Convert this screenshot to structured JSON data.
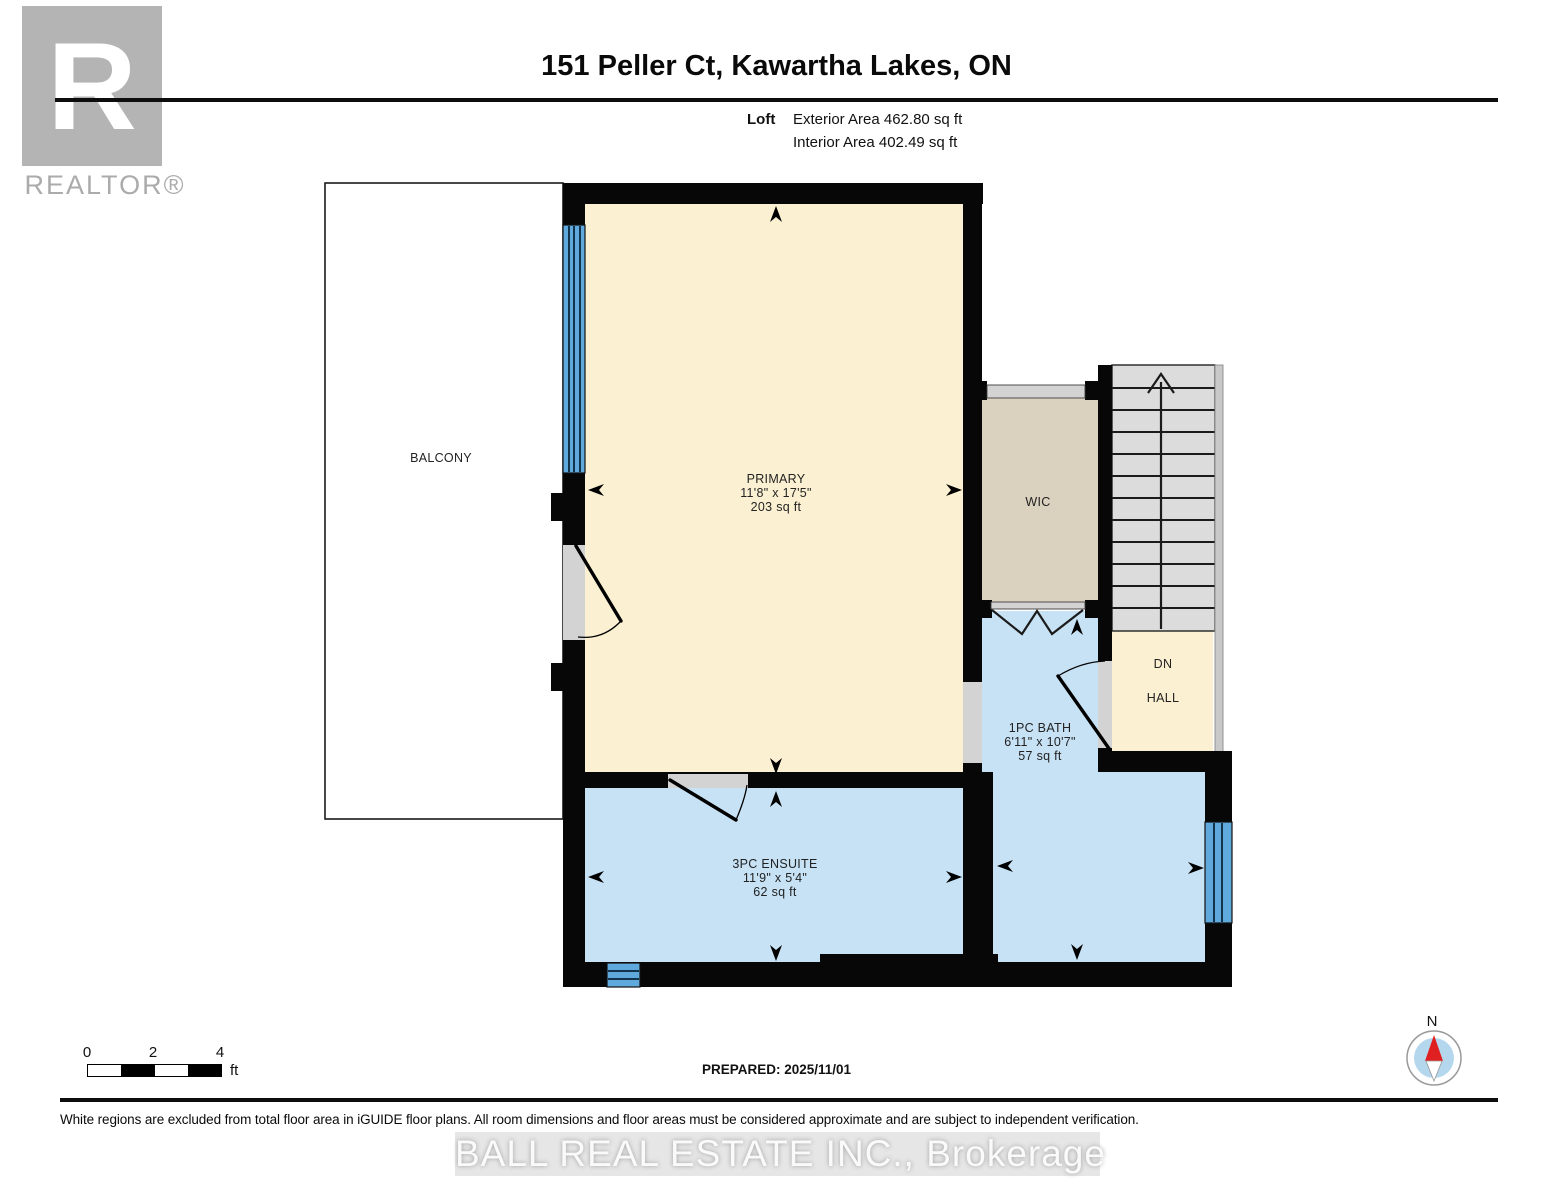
{
  "header": {
    "title": "151 Peller Ct, Kawartha Lakes, ON",
    "floor_label": "Loft",
    "exterior_area": "Exterior Area 462.80 sq ft",
    "interior_area": "Interior Area 402.49 sq ft"
  },
  "branding": {
    "realtor_letter": "R",
    "realtor_name": "REALTOR®",
    "brokerage_watermark": "BALL REAL ESTATE INC., Brokerage"
  },
  "rooms": {
    "balcony": {
      "label": "BALCONY"
    },
    "primary": {
      "label": "PRIMARY",
      "dims": "11'8\" x 17'5\"",
      "area": "203 sq ft"
    },
    "wic": {
      "label": "WIC"
    },
    "bath": {
      "label": "1PC BATH",
      "dims": "6'11\" x 10'7\"",
      "area": "57 sq ft"
    },
    "hall": {
      "dn": "DN",
      "label": "HALL"
    },
    "ensuite": {
      "label": "3PC ENSUITE",
      "dims": "11'9\" x 5'4\"",
      "area": "62 sq ft"
    }
  },
  "scale_bar": {
    "tick0": "0",
    "tick2": "2",
    "tick4": "4",
    "unit": "ft"
  },
  "footer": {
    "prepared": "PREPARED: 2025/11/01",
    "disclaimer": "White regions are excluded from total floor area in iGUIDE floor plans. All room dimensions and floor areas must be considered approximate and are subject to independent verification."
  },
  "compass": {
    "north": "N"
  },
  "colors": {
    "cream": "#FBF1D2",
    "room-blue": "#C7E2F5",
    "beige": "#DBD1BF",
    "stair-gray": "#DCDCDC",
    "open-gray": "#D3D3D3",
    "window-blue": "#5FA9DC",
    "wall-black": "#070707",
    "compass-red": "#E02020",
    "compass-blue": "#B5D7EE"
  }
}
